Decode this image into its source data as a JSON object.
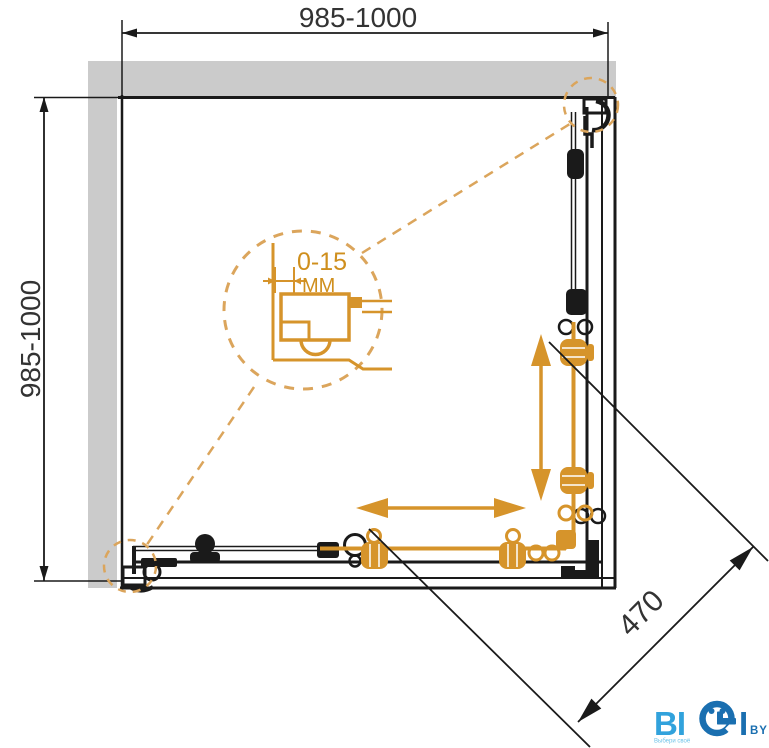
{
  "drawing": {
    "title": "corner-shower-enclosure-technical-drawing",
    "dimensions": {
      "top": "985-1000",
      "left": "985-1000",
      "diagonal": "470"
    },
    "detail": {
      "range": "0-15",
      "unit": "MM"
    },
    "colors": {
      "accent_orange": "#d6942b",
      "dashed_orange": "#dba55c",
      "wall_gray": "#cbcbcb",
      "line_black": "#1a1a1a",
      "logo_light_blue": "#31a2dc",
      "logo_dark_blue": "#1a6fb0"
    },
    "logo": {
      "part1": "BI",
      "part2": "I",
      "suffix": "BY",
      "slogan": "Выбери своё"
    }
  }
}
